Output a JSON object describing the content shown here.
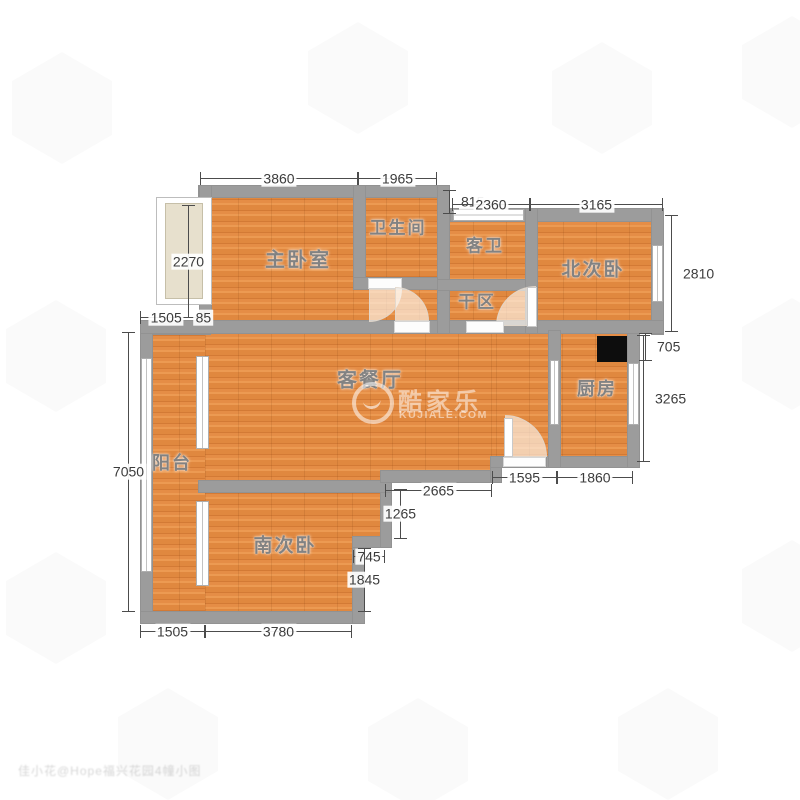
{
  "rooms": {
    "master": "主卧室",
    "bath": "卫生间",
    "guest_bath": "客卫",
    "north_bed": "北次卧",
    "dry_area": "干区",
    "living": "客餐厅",
    "kitchen": "厨房",
    "balcony": "阳台",
    "south_bed": "南次卧"
  },
  "dims": {
    "d3860": "3860",
    "d1965": "1965",
    "d815": "815",
    "d2360": "2360",
    "d3165": "3165",
    "d2270": "2270",
    "d2810": "2810",
    "d705": "705",
    "d3265": "3265",
    "d1595": "1595",
    "d1860": "1860",
    "d2665": "2665",
    "d1265": "1265",
    "d745": "745",
    "d1845": "1845",
    "d7050": "7050",
    "d1505_top": "1505",
    "d85": "85",
    "d1505_bottom": "1505",
    "d3780": "3780"
  },
  "watermark": {
    "brand": "酷家乐",
    "site": "KUJIALE.COM",
    "corner": "佳小花@Hope福兴花园4幢小图"
  },
  "colors": {
    "floor": "#e0883f",
    "wall": "#9c9c9c",
    "flue": "#0d0d0d",
    "dim_text": "#3c3c3c"
  }
}
